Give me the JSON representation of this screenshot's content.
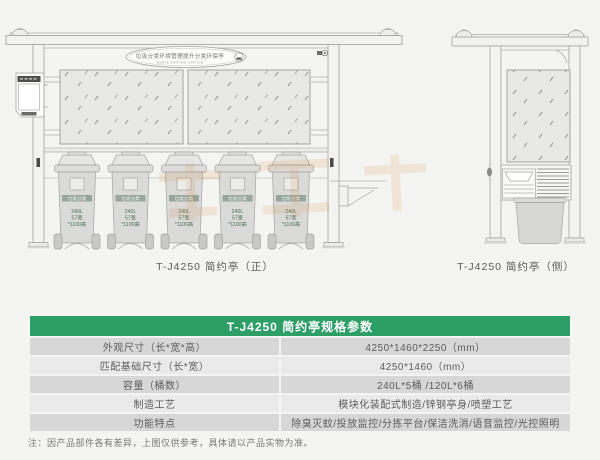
{
  "front_view": {
    "caption": "T-J4250 简约亭（正）",
    "sign_title": "垃圾分类环境管理提升分类环保亭",
    "sign_subtitle": "WASTE SORTING STATION",
    "bin_band_label": "垃圾分类",
    "bin_spec_line1": "240L",
    "bin_spec_line2": "57宽",
    "bin_spec_line3": "*1100高",
    "bin_count": 5
  },
  "side_view": {
    "caption": "T-J4250 简约亭（侧）"
  },
  "spec_table": {
    "title": "T-J4250 简约亭规格参数",
    "rows": [
      {
        "label": "外观尺寸（长*宽*高）",
        "value": "4250*1460*2250（mm）"
      },
      {
        "label": "匹配基础尺寸（长*宽）",
        "value": "4250*1460（mm）"
      },
      {
        "label": "容量（桶数）",
        "value": "240L*5桶 /120L*6桶"
      },
      {
        "label": "制造工艺",
        "value": "模块化装配式制造/锌钢亭身/喷塑工艺"
      },
      {
        "label": "功能特点",
        "value": "除臭灭蚊/投放监控/分拣平台/保洁洗消/语音监控/光控照明"
      }
    ]
  },
  "footnote": "注：因产品部件各有差异，上图仅供参考，具体请以产品实物为准。",
  "colors": {
    "table_header_green": "#2e9e67",
    "row_light": "#eaeaea",
    "row_dark": "#d7d7d7",
    "watermark_orange": "#d98a3a",
    "drawing_line": "#a2a2a0"
  }
}
